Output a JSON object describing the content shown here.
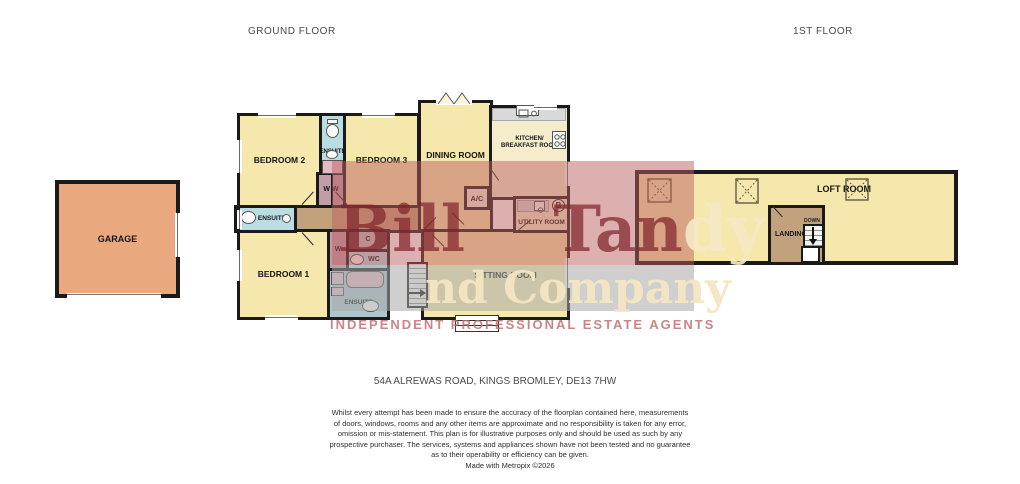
{
  "header": {
    "ground_floor": "GROUND FLOOR",
    "first_floor": "1ST FLOOR"
  },
  "ground": {
    "garage": "GARAGE",
    "bedroom1": "BEDROOM 1",
    "bedroom2": "BEDROOM 2",
    "bedroom3": "BEDROOM 3",
    "ensuite_bed2": "ENSUITE",
    "ensuite_hall": "ENSUITE",
    "ensuite_bed1": "ENSUITE",
    "wardrobe_double": "W W",
    "wardrobe_single": "W",
    "cupboard": "C",
    "wc": "WC",
    "dining": "DINING ROOM",
    "kitchen_line1": "KITCHEN/",
    "kitchen_line2": "BREAKFAST ROOM",
    "ac": "A/C",
    "utility": "UTILITY ROOM",
    "sitting": "SITTING ROOM",
    "boiler": "B"
  },
  "first": {
    "loft": "LOFT ROOM",
    "landing": "LANDING",
    "down": "DOWN"
  },
  "watermark": {
    "brand_dark": "Bill Tan",
    "brand_light": "dy",
    "company": "nd Company",
    "tagline": "INDEPENDENT PROFESSIONAL ESTATE AGENTS"
  },
  "address": "54A ALREWAS ROAD, KINGS BROMLEY, DE13 7HW",
  "disclaimer": {
    "lines": [
      "Whilst every attempt has been made to ensure the accuracy of the floorplan contained here, measurements",
      "of doors, windows, rooms and any other items are approximate and no responsibility is taken for any error,",
      "omission or mis-statement. This plan is for illustrative purposes only and should be used as such by any",
      "prospective purchaser. The services, systems and appliances shown have not been tested and no guarantee",
      "as to their operability or efficiency can be given."
    ],
    "credit": "Made with Metropix ©2026"
  },
  "colors": {
    "room_cream": "#f6e8ad",
    "garage_orange": "#e9a87d",
    "bathroom_blue": "#b9dde3",
    "wardrobe_mauve": "#c29da6",
    "cupboard_gray": "#bdbdbd",
    "hall_tan": "#c2a27d",
    "wall_black": "#1a1a1a",
    "watermark_red": "#bc6060",
    "watermark_gray": "#a8a8a8",
    "brand_maroon": "#80242a",
    "brand_cream": "#f5e7c4",
    "tagline_pink": "#c36e6e"
  }
}
